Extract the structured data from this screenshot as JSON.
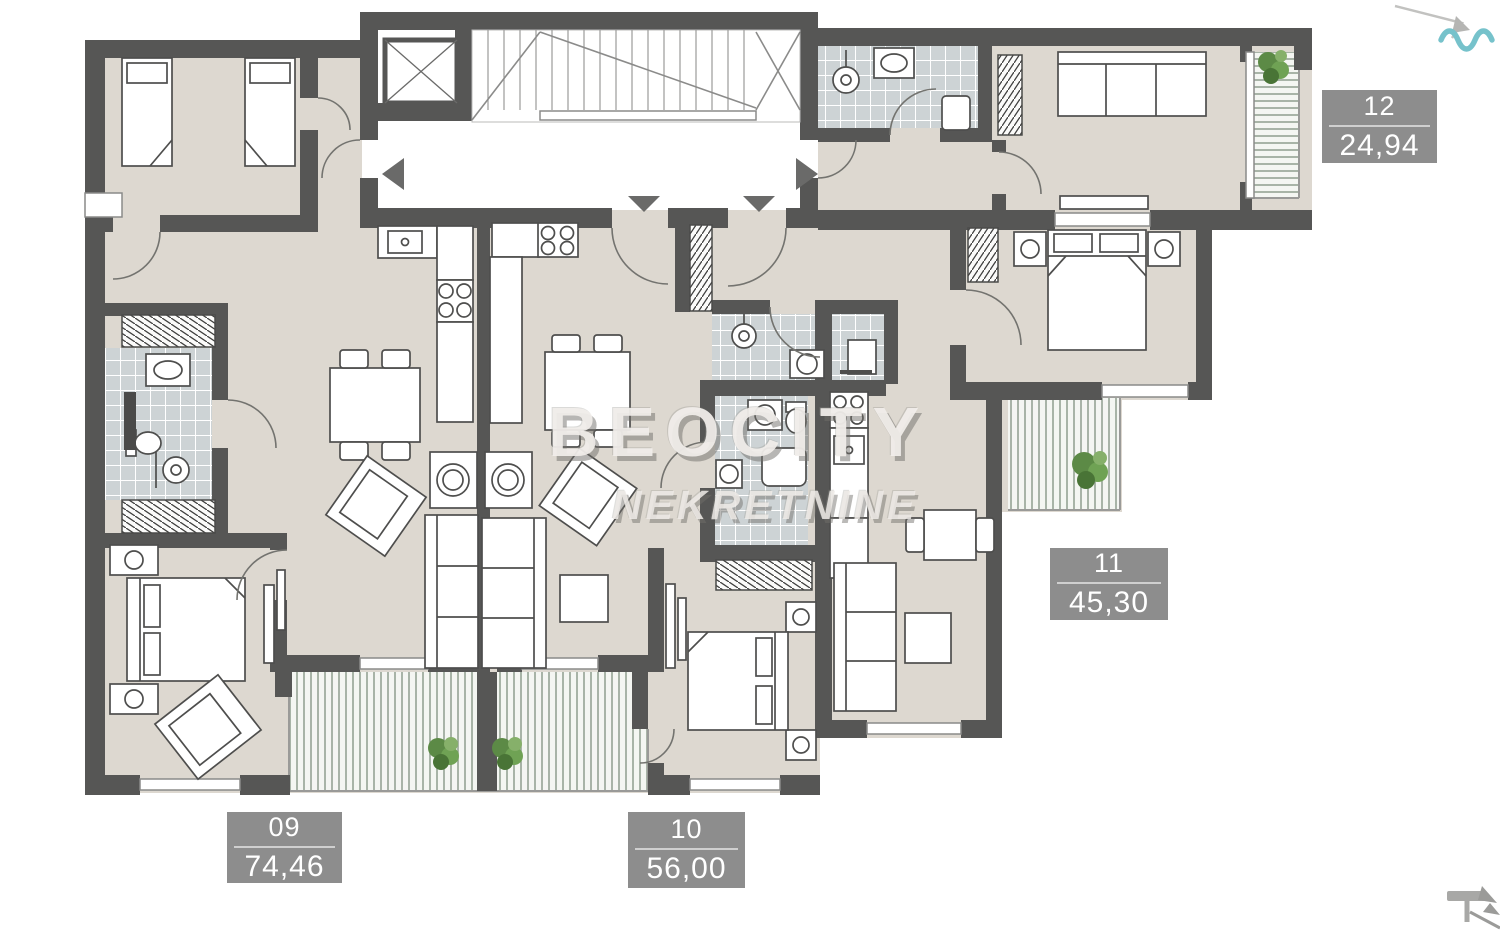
{
  "watermark": {
    "line1": "BEOCITY",
    "line2": "NEKRETNINE"
  },
  "labels": {
    "apt09": {
      "number": "09",
      "area": "74,46"
    },
    "apt10": {
      "number": "10",
      "area": "56,00"
    },
    "apt11": {
      "number": "11",
      "area": "45,30"
    },
    "apt12": {
      "number": "12",
      "area": "24,94"
    }
  },
  "colors": {
    "wall": "#565655",
    "floor": "#ddd8d0",
    "tile_floor": "#cdd3d5",
    "balcony_stripe": "#8f9e8e",
    "label_background": "#8d8d8d",
    "label_text": "#ffffff",
    "wave_accent": "#76c2cb",
    "plant_green": "#5c8a46",
    "arrow_gray": "#6a6a69"
  },
  "icons": {
    "top_right": "wave-icon",
    "bottom_right": "north-arrow-icon"
  }
}
